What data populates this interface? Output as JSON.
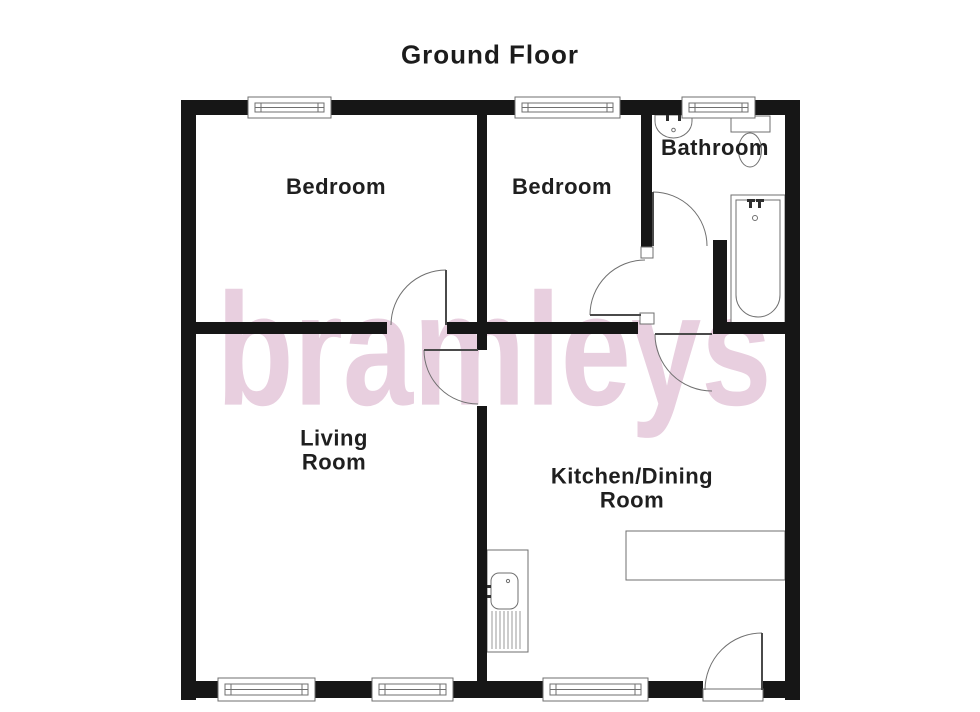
{
  "title": "Ground Floor",
  "watermark": {
    "text": "bramleys",
    "color": "#e8cfdf"
  },
  "colors": {
    "wall": "#161616",
    "line": "#6f6f6f",
    "leaf": "#4a4a4a",
    "fixture_dark": "#2e2e2e",
    "hatch": "#999999",
    "text": "#1f1f1f"
  },
  "rooms": [
    {
      "id": "bedroom-1",
      "label": "Bedroom",
      "cx": 336,
      "cy": 187
    },
    {
      "id": "bedroom-2",
      "label": "Bedroom",
      "cx": 562,
      "cy": 187
    },
    {
      "id": "bathroom",
      "label": "Bathroom",
      "cx": 715,
      "cy": 148
    },
    {
      "id": "living-room",
      "label": "Living\nRoom",
      "cx": 334,
      "cy": 450
    },
    {
      "id": "kitchen-dining-room",
      "label": "Kitchen/Dining\nRoom",
      "cx": 632,
      "cy": 488
    }
  ],
  "plan": {
    "walls": [
      [
        181,
        100,
        15,
        600
      ],
      [
        785,
        100,
        15,
        600
      ],
      [
        181,
        100,
        67,
        15
      ],
      [
        331,
        100,
        184,
        15
      ],
      [
        620,
        100,
        62,
        15
      ],
      [
        755,
        100,
        45,
        15
      ],
      [
        181,
        681,
        37,
        17
      ],
      [
        315,
        681,
        57,
        17
      ],
      [
        453,
        681,
        90,
        17
      ],
      [
        648,
        681,
        55,
        17
      ],
      [
        763,
        681,
        37,
        17
      ],
      [
        477,
        115,
        10,
        217
      ],
      [
        477,
        334,
        10,
        16
      ],
      [
        477,
        406,
        10,
        275
      ],
      [
        641,
        115,
        11,
        132
      ],
      [
        196,
        322,
        191,
        12
      ],
      [
        447,
        322,
        191,
        12
      ],
      [
        713,
        322,
        87,
        12
      ],
      [
        713,
        240,
        14,
        94
      ]
    ],
    "jambs": [
      [
        641,
        247,
        12,
        11
      ],
      [
        640,
        313,
        14,
        11
      ]
    ],
    "windows": [
      [
        248,
        97,
        83,
        21
      ],
      [
        515,
        97,
        105,
        21
      ],
      [
        682,
        97,
        73,
        21
      ],
      [
        218,
        678,
        97,
        23
      ],
      [
        372,
        678,
        81,
        23
      ],
      [
        543,
        678,
        105,
        23
      ]
    ],
    "threshold": [
      703,
      689,
      60,
      12
    ],
    "doors": [
      {
        "name": "bedroom1-door",
        "arc": "M446,270 A55,55 0 0 0 391,325",
        "leaf": [
          446,
          270,
          446,
          325
        ]
      },
      {
        "name": "bedroom2-door",
        "arc": "M645,260 A55,55 0 0 0 590,315",
        "leaf": [
          590,
          315,
          641,
          315
        ]
      },
      {
        "name": "hall-kitchen-door",
        "arc": "M655,334 A57,57 0 0 0 712,391",
        "leaf": [
          655,
          334,
          712,
          334
        ]
      },
      {
        "name": "living-room-door",
        "arc": "M424,350 A54,54 0 0 0 478,404",
        "leaf": [
          424,
          350,
          478,
          350
        ]
      },
      {
        "name": "kitchen-entry-door",
        "arc": "M705,690 A57,57 0 0 1 762,633",
        "leaf": [
          762,
          633,
          762,
          690
        ]
      },
      {
        "name": "bathroom-door",
        "arc": "M653,192 A54,54 0 0 1 707,246",
        "leaf": [
          653,
          192,
          653,
          246
        ]
      }
    ],
    "fixtures": [
      {
        "t": "path",
        "name": "bathroom-basin",
        "d": "M655,115 L692,115 L692,121 A18.5,17 0 0 1 655,121 Z",
        "fill": "white"
      },
      {
        "t": "circle",
        "name": "basin-drain",
        "cx": 673.5,
        "cy": 130,
        "r": 1.8,
        "fill": "none"
      },
      {
        "t": "rect",
        "name": "basin-tap",
        "x": 664,
        "y": 112,
        "w": 8,
        "h": 3,
        "fill": "dark"
      },
      {
        "t": "rect",
        "name": "basin-tap",
        "x": 676,
        "y": 112,
        "w": 8,
        "h": 3,
        "fill": "dark"
      },
      {
        "t": "rect",
        "name": "basin-tap",
        "x": 666,
        "y": 114,
        "w": 3,
        "h": 7,
        "fill": "dark"
      },
      {
        "t": "rect",
        "name": "basin-tap",
        "x": 678,
        "y": 114,
        "w": 3,
        "h": 7,
        "fill": "dark"
      },
      {
        "t": "rect",
        "name": "toilet-cistern",
        "x": 731,
        "y": 116,
        "w": 39,
        "h": 16,
        "fill": "white"
      },
      {
        "t": "ellipse",
        "name": "toilet-bowl",
        "cx": 750,
        "cy": 150,
        "rx": 11.5,
        "ry": 17,
        "fill": "white"
      },
      {
        "t": "rect",
        "name": "bathtub",
        "x": 731,
        "y": 195,
        "w": 54,
        "h": 132,
        "fill": "white"
      },
      {
        "t": "path",
        "name": "bathtub-inner",
        "d": "M736,200 L780,200 L780,295 A22,22 0 0 1 736,295 Z",
        "fill": "none"
      },
      {
        "t": "rect",
        "name": "bath-tap",
        "x": 747,
        "y": 199,
        "w": 8,
        "h": 3,
        "fill": "dark"
      },
      {
        "t": "rect",
        "name": "bath-tap",
        "x": 756,
        "y": 199,
        "w": 8,
        "h": 3,
        "fill": "dark"
      },
      {
        "t": "rect",
        "name": "bath-tap",
        "x": 749,
        "y": 201,
        "w": 3,
        "h": 7,
        "fill": "dark"
      },
      {
        "t": "rect",
        "name": "bath-tap",
        "x": 758,
        "y": 201,
        "w": 3,
        "h": 7,
        "fill": "dark"
      },
      {
        "t": "circle",
        "name": "bath-drain",
        "cx": 755,
        "cy": 218,
        "r": 2.5,
        "fill": "none"
      },
      {
        "t": "rect",
        "name": "kitchen-sink-unit",
        "x": 487,
        "y": 550,
        "w": 41,
        "h": 102,
        "fill": "white"
      },
      {
        "t": "rrect",
        "name": "kitchen-sink-bowl",
        "x": 491,
        "y": 573,
        "w": 27,
        "h": 36,
        "rx": 8,
        "fill": "none"
      },
      {
        "t": "circle",
        "name": "sink-drain",
        "cx": 508,
        "cy": 581,
        "r": 1.6,
        "fill": "none"
      },
      {
        "t": "rect",
        "name": "sink-tap",
        "x": 482,
        "y": 585,
        "w": 9,
        "h": 3,
        "fill": "dark"
      },
      {
        "t": "rect",
        "name": "sink-tap",
        "x": 482,
        "y": 595,
        "w": 9,
        "h": 3,
        "fill": "dark"
      },
      {
        "t": "hatch",
        "name": "drainer-lines",
        "x1": 492,
        "x2": 520,
        "step": 4,
        "y1": 611,
        "y2": 649
      },
      {
        "t": "rect",
        "name": "kitchen-counter",
        "x": 626,
        "y": 531,
        "w": 159,
        "h": 49,
        "fill": "white"
      }
    ]
  }
}
